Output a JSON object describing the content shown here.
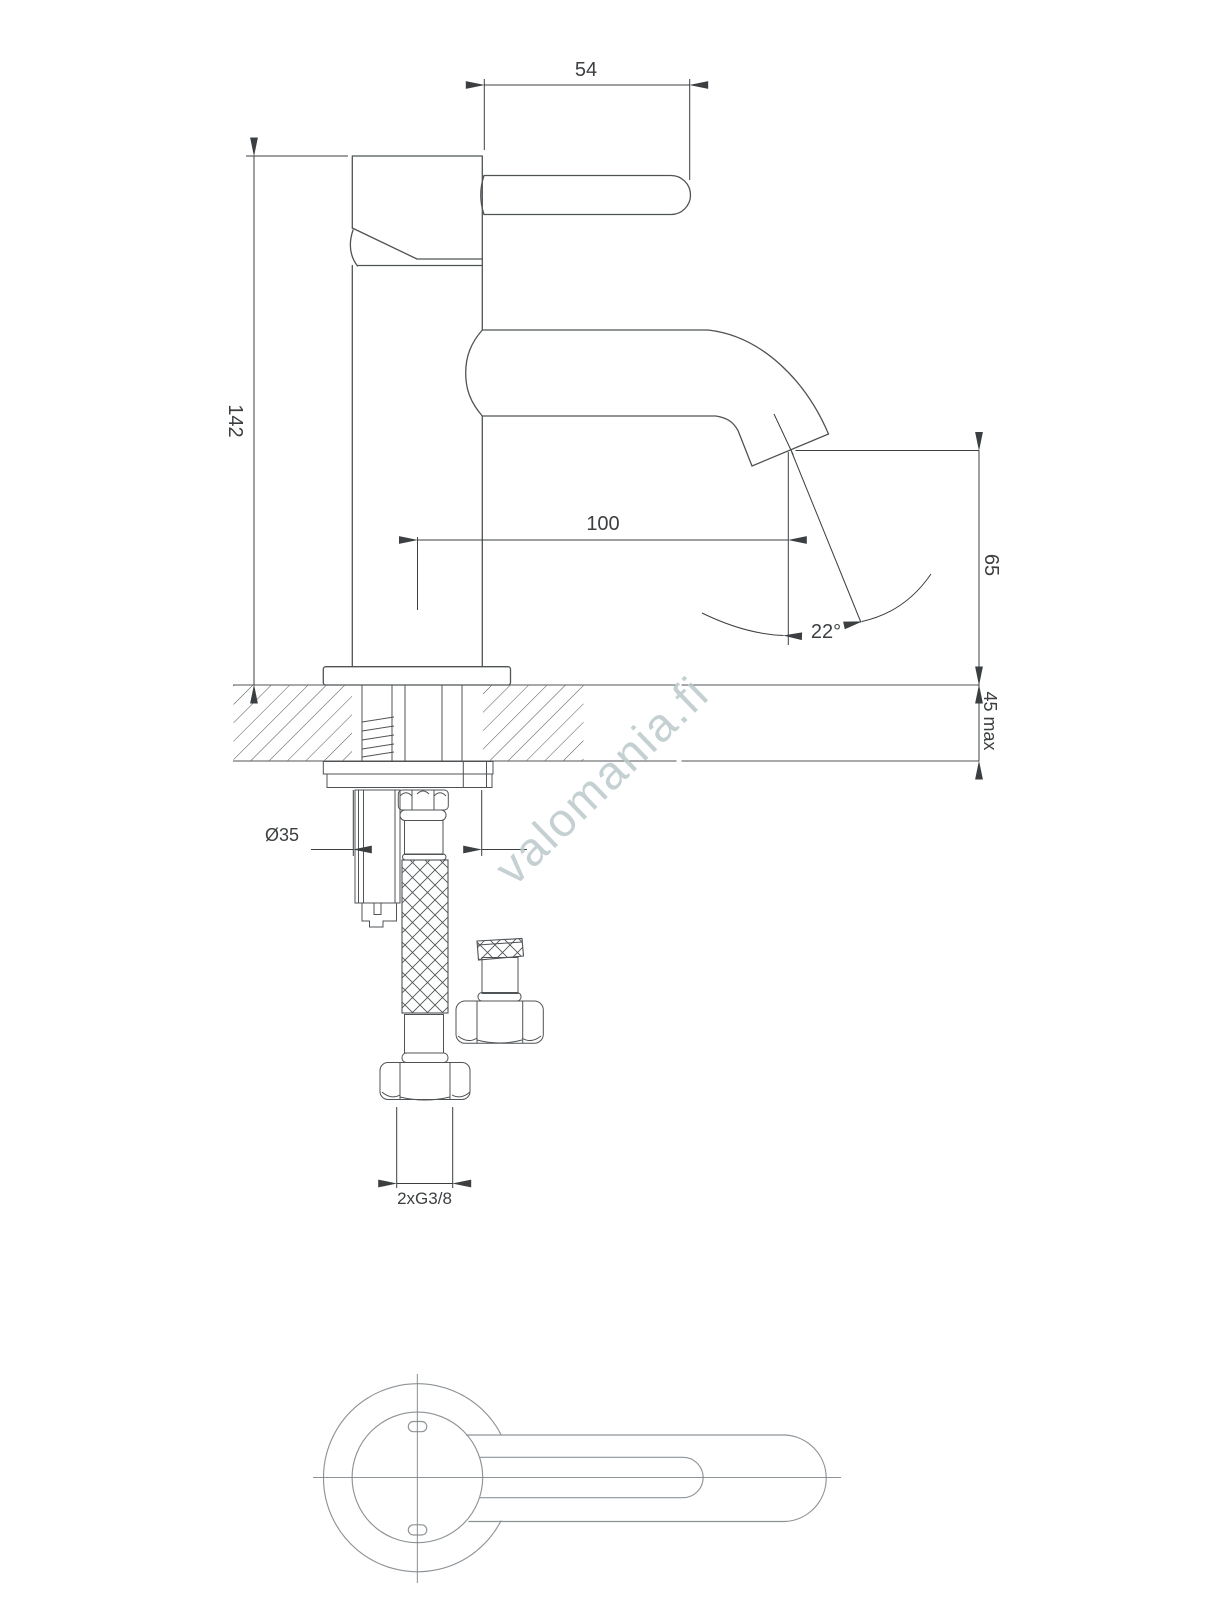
{
  "drawing": {
    "type": "technical-dimension-drawing",
    "subject": "single-lever basin faucet — side section with mounting hardware and top view",
    "watermark": "valomania.fi"
  },
  "dimensions": {
    "handle_length": "54",
    "total_height": "142",
    "spout_reach": "100",
    "outlet_height": "65",
    "deck_thickness": "45 max",
    "stream_angle": "22°",
    "hole_diameter": "Ø35",
    "supply_connection": "2xG3/8"
  },
  "colors": {
    "background": "#ffffff",
    "outline": "#4f5356",
    "dimension": "#3c3f41",
    "top_view": "#8d9397",
    "watermark": "#bac8ca"
  }
}
